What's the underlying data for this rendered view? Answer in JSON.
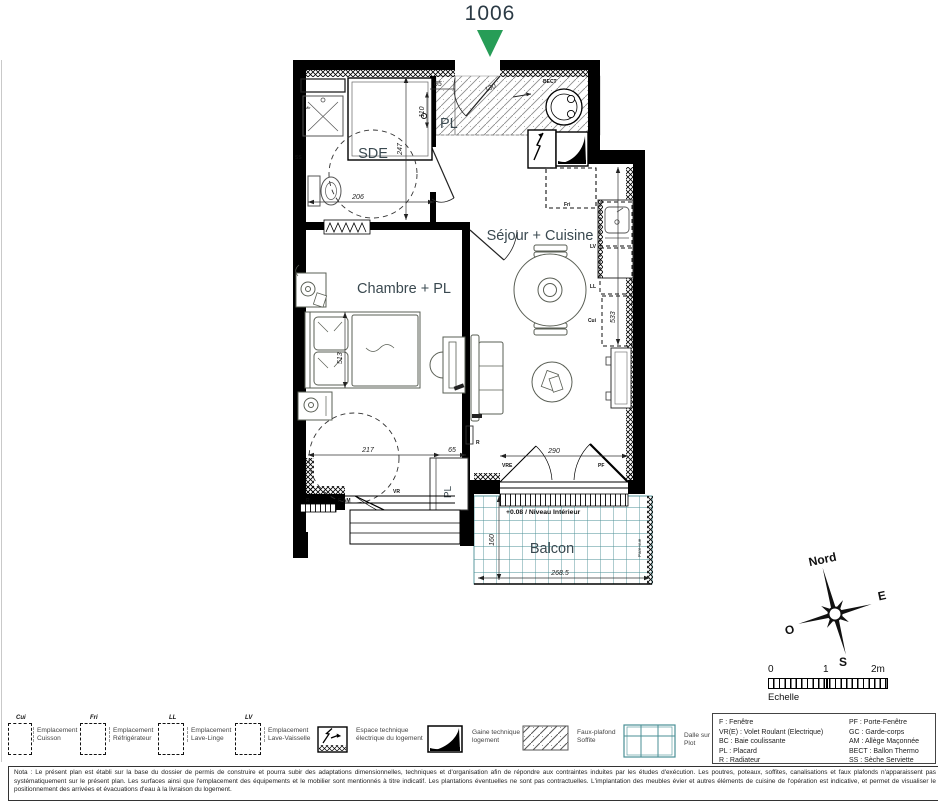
{
  "title": {
    "unit": "1006"
  },
  "plan": {
    "rooms": {
      "sde": "SDE",
      "pl_top": "PL",
      "sejour": "Séjour + Cuisine",
      "chambre": "Chambre + PL",
      "pl_bottom": "PL",
      "balcon": "Balcon"
    },
    "fixtures": {
      "bect": "BECT",
      "fri": "Fri",
      "lv": "LV",
      "ll": "LL",
      "cui": "Cui",
      "ss": "SS",
      "mir": "Mir",
      "r_sejour": "R",
      "r_chambre": "R",
      "vre": "VRE",
      "pf": "PF",
      "vr": "VR",
      "f_am": "F-AM",
      "niveau": "+0.08 / Niveau Intérieur",
      "pare_vue": "Pare-vue"
    },
    "dims": {
      "entree": "130",
      "pl_w": "65",
      "pl_h": "110",
      "sde_h": "247",
      "sde_w": "206",
      "cuisine_h": "533",
      "lit_h": "513",
      "chambre_w": "217",
      "pl2_w": "65",
      "pf_w": "290",
      "balcon_h": "160",
      "balcon_w": "268.5"
    }
  },
  "compass": {
    "n": "Nord",
    "e": "E",
    "o": "O",
    "s": "S"
  },
  "scale": {
    "zero": "0",
    "one": "1",
    "two": "2m",
    "label": "Echelle"
  },
  "legend": {
    "cuisson": {
      "tag": "Cui",
      "label": "Emplacement Cuisson"
    },
    "refrigerateur": {
      "tag": "Fri",
      "label": "Emplacement Réfrigérateur"
    },
    "lave_linge": {
      "tag": "LL",
      "label": "Emplacement Lave-Linge"
    },
    "lave_vaisselle": {
      "tag": "LV",
      "label": "Emplacement Lave-Vaisselle"
    },
    "espace_technique": {
      "label": "Espace technique électrique du logement"
    },
    "gaine": {
      "label": "Gaine technique logement"
    },
    "faux_plafond": {
      "label": "Faux-plafond Soffite"
    },
    "dalle": {
      "label": "Dalle sur Plot"
    }
  },
  "abbreviations": {
    "col1": [
      "F : Fenêtre",
      "VR(E) : Volet Roulant (Electrique)",
      "BC : Baie coulissante",
      "PL : Placard",
      "R : Radiateur"
    ],
    "col2": [
      "PF : Porte-Fenêtre",
      "GC : Garde-corps",
      "AM : Allège Maçonnée",
      "BECT : Ballon Thermo",
      "SS : Sèche Serviette"
    ]
  },
  "nota": "Nota : Le présent plan est établi sur la base du dossier de permis de construire et pourra subir des adaptations dimensionnelles, techniques et d'organisation afin de répondre aux contraintes induites par les études d'exécution. Les poutres, poteaux, soffites, canalisations et faux plafonds n'apparaissent pas systématiquement sur le présent plan. Les surfaces ainsi que l'emplacement des équipements et le mobilier sont mentionnés à titre indicatif. Les plantations éventuelles ne sont pas contractuelles. L'implantation des meubles évier et autres éléments de cuisine de l'opération est indicative, et permet de visualiser le positionnement des arrivées et évacuations d'eau à la livraison du logement.",
  "colors": {
    "accent_green": "#279d57",
    "wall": "#000000",
    "grid_teal": "#4a8f95",
    "label": "#3a4950"
  }
}
